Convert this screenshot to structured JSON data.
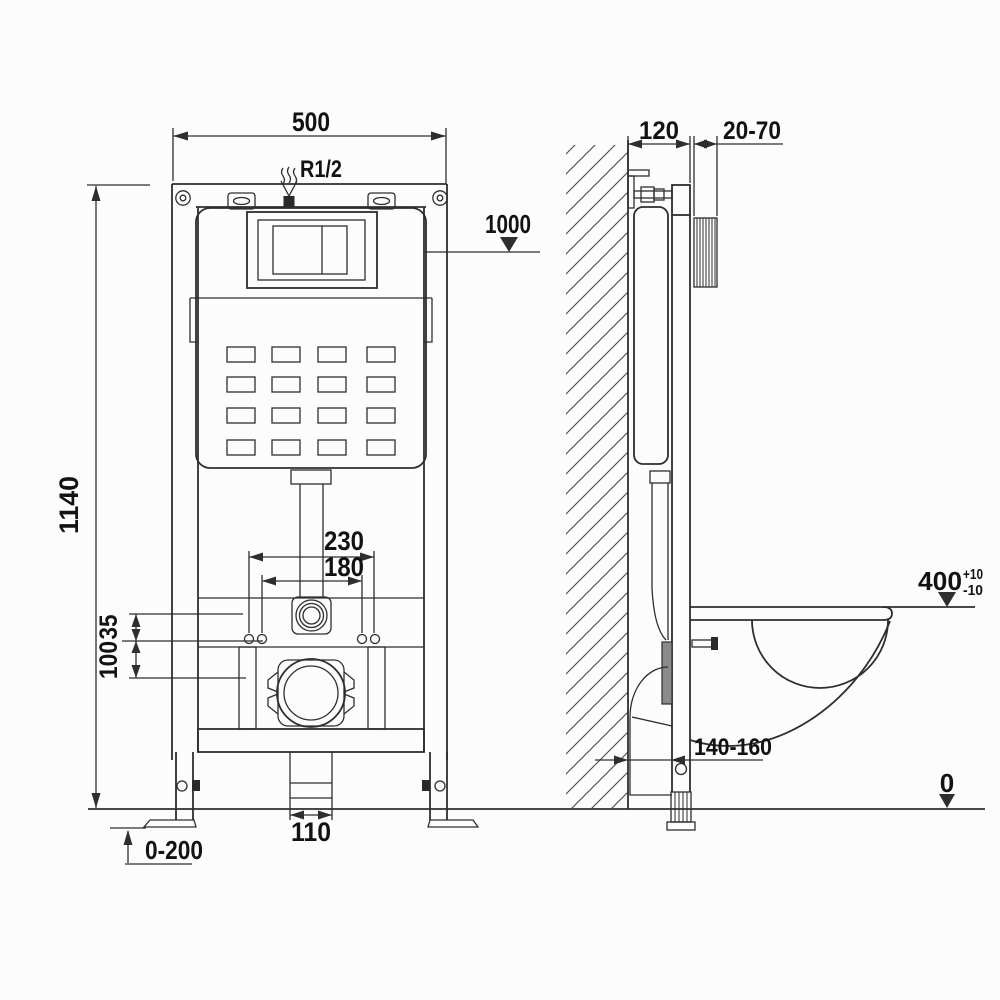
{
  "diagram": {
    "kind": "wall-hung toilet concealed cistern frame installation drawing",
    "units_hint": "mm"
  },
  "front_view": {
    "labels": {
      "width": "500",
      "inlet_thread": "R1/2",
      "button_height": "1000",
      "frame_height": "1140",
      "fixing_span_outer": "230",
      "fixing_span_inner": "180",
      "offset_upper": "35",
      "offset_lower": "100",
      "drain_width": "110",
      "leg_adjust_range": "0-200"
    }
  },
  "side_view": {
    "labels": {
      "frame_depth": "120",
      "wall_finish_range": "20-70",
      "bowl_height": "400",
      "bowl_height_tol_plus": "+10",
      "bowl_height_tol_minus": "-10",
      "drain_offset_range": "140-160",
      "floor_level": "0"
    }
  },
  "colors": {
    "line": "#2e2e2e",
    "text": "#121212",
    "background": "#fcfcfc"
  }
}
